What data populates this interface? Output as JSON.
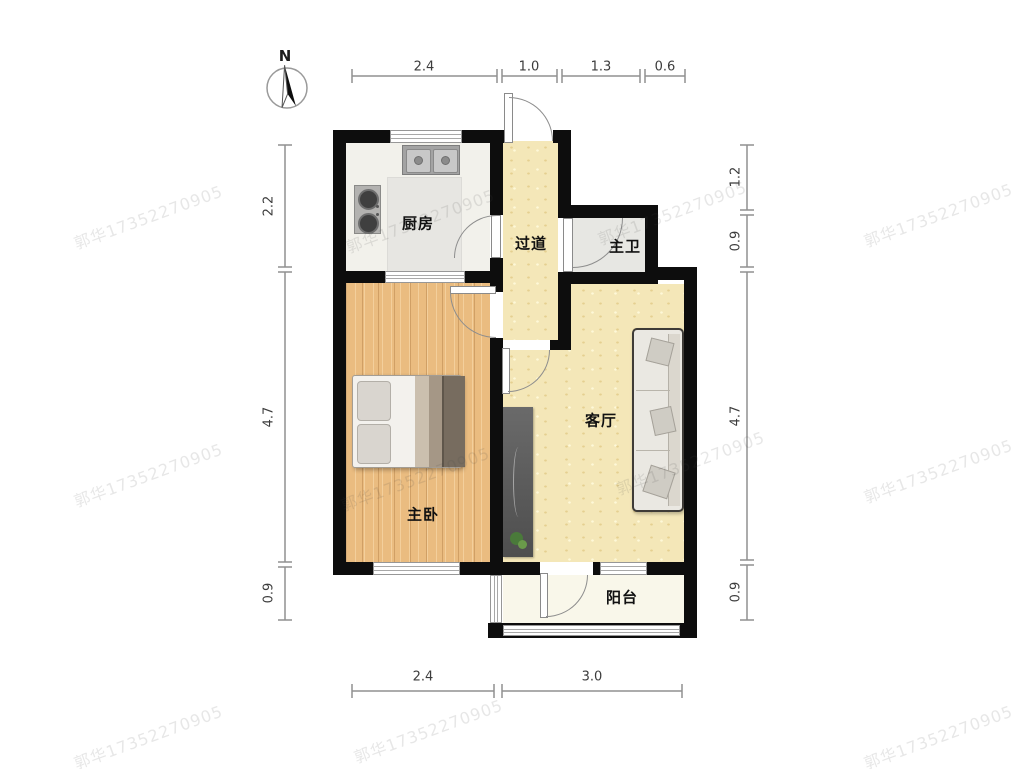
{
  "north_label": "N",
  "watermark_text": "郭华17352270905",
  "rooms": {
    "kitchen": "厨房",
    "hallway": "过道",
    "master_bath": "主卫",
    "master_bedroom": "主卧",
    "living_room": "客厅",
    "balcony": "阳台"
  },
  "dimensions": {
    "top": [
      "2.4",
      "1.0",
      "1.3",
      "0.6"
    ],
    "left": [
      "2.2",
      "4.7",
      "0.9"
    ],
    "right": [
      "1.2",
      "0.9",
      "4.7",
      "0.9"
    ],
    "bottom": [
      "2.4",
      "3.0"
    ]
  },
  "colors": {
    "wall": "#0d0d0d",
    "floor_public": "#f4e7b8",
    "floor_bedroom": "#eabc80",
    "floor_kitchen": "#f2f1eb",
    "floor_bath": "#e7e7e3",
    "floor_balcony": "#f9f7ea",
    "dimension_line": "#909090"
  }
}
